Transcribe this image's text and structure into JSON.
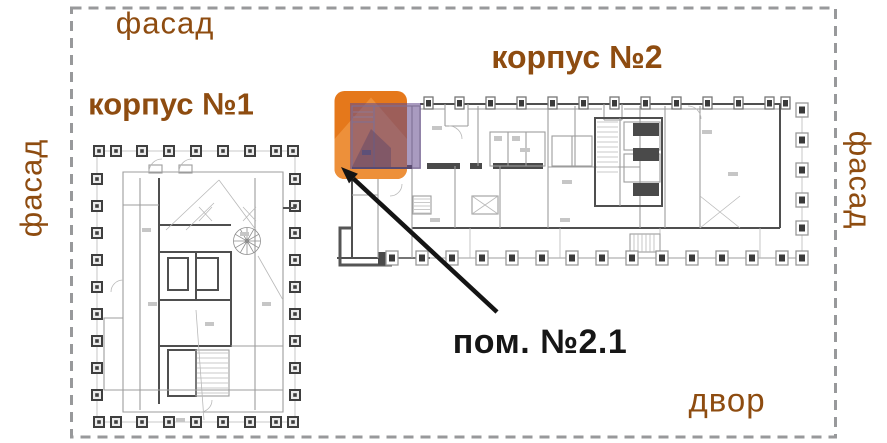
{
  "scene": {
    "width": 887,
    "height": 443,
    "background": "#ffffff"
  },
  "boundary": {
    "type": "dashed-rectangle",
    "color": "#98999b"
  },
  "labels": {
    "facade_top": "фасад",
    "facade_left": "фасад",
    "facade_right": "фасад",
    "building1": "корпус №1",
    "building2": "корпус №2",
    "room": "пом. №2.1",
    "yard": "двор"
  },
  "colors": {
    "label_brown": "#8e4c10",
    "room_label": "#161616",
    "marker_orange": "#e5781b",
    "marker_orange_light": "#ef9440",
    "overlay_purple": "rgba(99,73,140,0.55)",
    "overlay_purple_dark": "rgba(70,58,102,0.35)",
    "arrow_black": "#141414",
    "plan_dark": "#4a4a4a",
    "plan_light": "#9d9d9d"
  },
  "marker": {
    "icon": "home-icon",
    "target_room": "пом. №2.1"
  }
}
